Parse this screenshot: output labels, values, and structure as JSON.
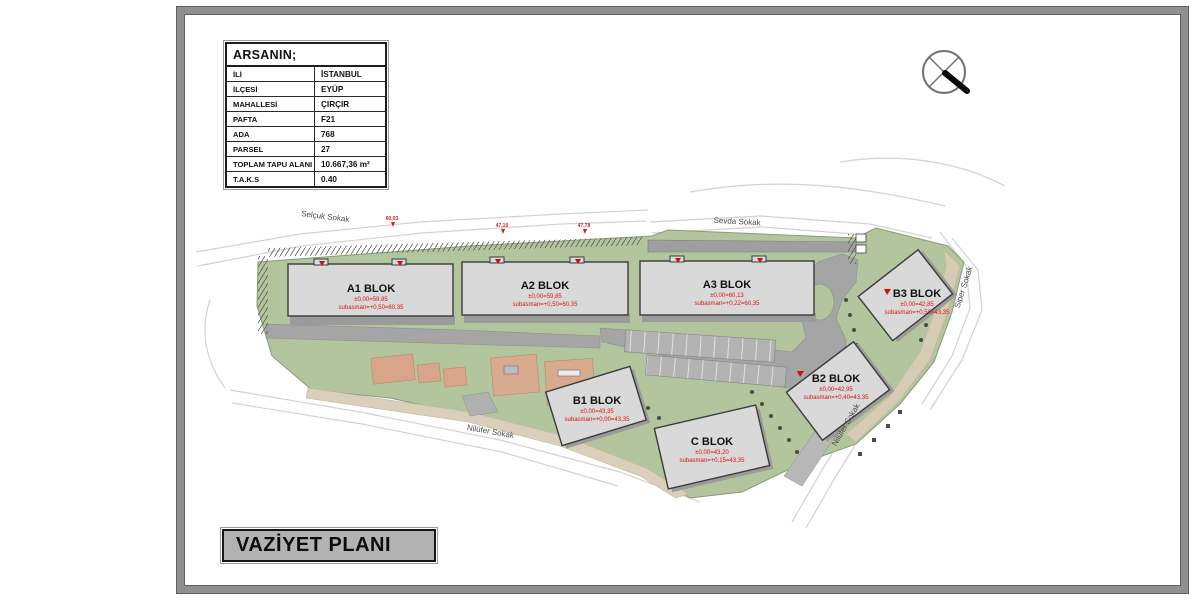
{
  "sheet": {
    "title": "VAZİYET PLANI"
  },
  "info_table": {
    "header": "ARSANIN;",
    "rows": [
      {
        "label": "İLİ",
        "value": "İSTANBUL"
      },
      {
        "label": "İLÇESİ",
        "value": "EYÜP"
      },
      {
        "label": "MAHALLESİ",
        "value": "ÇIRÇIR"
      },
      {
        "label": "PAFTA",
        "value": "F21"
      },
      {
        "label": "ADA",
        "value": "768"
      },
      {
        "label": "PARSEL",
        "value": "27"
      },
      {
        "label": "TOPLAM TAPU ALANI",
        "value": "10.667,36 m²"
      },
      {
        "label": "T.A.K.S",
        "value": "0.40"
      }
    ]
  },
  "blocks": [
    {
      "name": "A1 BLOK",
      "elev": "±0,00=59,85",
      "subasman": "subasman=+0,50=60,35"
    },
    {
      "name": "A2 BLOK",
      "elev": "±0,00=59,85",
      "subasman": "subasman=+0,50=60,35"
    },
    {
      "name": "A3 BLOK",
      "elev": "±0,00=60,13",
      "subasman": "subasman=+0,22=60,35"
    },
    {
      "name": "B1 BLOK",
      "elev": "±0,00=43,35",
      "subasman": "subasman=+0,00=43,35"
    },
    {
      "name": "B2 BLOK",
      "elev": "±0,00=42,95",
      "subasman": "subasman=+0,40=43,35"
    },
    {
      "name": "B3 BLOK",
      "elev": "±0,00=42,85",
      "subasman": "subasman=+0,50=43,35"
    },
    {
      "name": "C BLOK",
      "elev": "±0,00=43,20",
      "subasman": "subasman=+0,15=43,35"
    }
  ],
  "streets": {
    "selcuk": "Selçuk Sokak",
    "sevda": "Sevda Sokak",
    "siper": "Siper Sokak",
    "nilufer_sw": "Nilüfer Sokak",
    "nilufer_se": "Nilüfer Sokak"
  },
  "spot_elevations": [
    "60,03",
    "47,10",
    "47,78"
  ],
  "colors": {
    "site_green": "#b3c59c",
    "road_gray": "#a5a5a5",
    "building_fill": "#d9d9d9",
    "building_stroke": "#3a3a3a",
    "label_red": "#d81414",
    "tan_path": "#d9cfba",
    "playground_salmon": "#d8a58a",
    "frame_gray": "#8f8f8f",
    "title_box_gray": "#b2b2b2"
  }
}
